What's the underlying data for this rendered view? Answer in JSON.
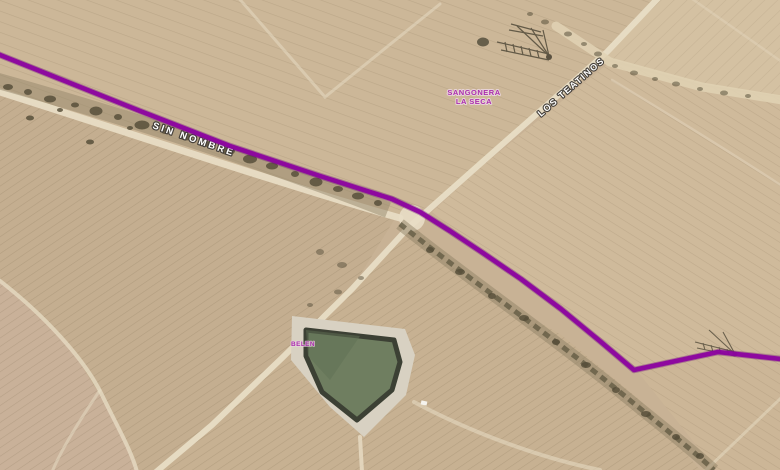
{
  "map": {
    "type": "satellite-imagery",
    "labels": {
      "road_main": "SIN NOMBRE",
      "road_diagonal": "LOS TEATINOS",
      "place_line1": "SANGONERA",
      "place_line2": "LA SECA",
      "pond_area": "BELEN"
    },
    "colors": {
      "route": "#8c03a0",
      "route_halo": "#650277",
      "place_label": "#ab2fae",
      "field_base": "#c8b295",
      "road_fill": "#e8ddc5",
      "pond_water": "#6f7e60",
      "pond_rim": "#3c4034",
      "pond_bank": "#d8d1c2",
      "vegetation": "#554d38"
    },
    "route": {
      "width": 4.6,
      "points": [
        [
          -5,
          53
        ],
        [
          60,
          79
        ],
        [
          140,
          111
        ],
        [
          230,
          146
        ],
        [
          320,
          176
        ],
        [
          392,
          199
        ],
        [
          420,
          212
        ],
        [
          450,
          231
        ],
        [
          483,
          253
        ],
        [
          521,
          279
        ],
        [
          561,
          309
        ],
        [
          601,
          342
        ],
        [
          634,
          370
        ],
        [
          718,
          352
        ],
        [
          781,
          359
        ]
      ]
    }
  }
}
